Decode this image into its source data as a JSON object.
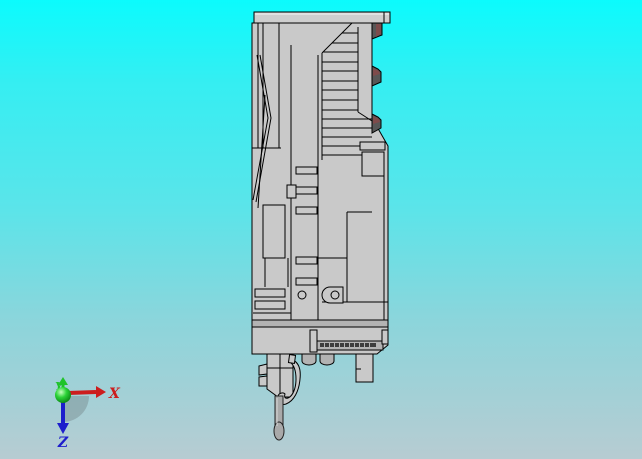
{
  "window": {
    "width": 642,
    "height": 459
  },
  "viewport": {
    "background_gradient": {
      "top": "#0bfbfd",
      "high": "#35eef2",
      "mid": "#5ce4e9",
      "low": "#8cd5db",
      "bottom": "#b7ccd2"
    }
  },
  "model": {
    "body_color": "#c9c9c9",
    "cap_color": "#cfcfcf",
    "face_shade_color": "#b3b3b3",
    "dark_detail_color": "#575757",
    "accent_detail_color": "#7d4b4b",
    "needle_color": "#a9a9a9",
    "outline_color": "#000000"
  },
  "triad": {
    "x_axis": {
      "label": "X",
      "color": "#cc1d1d"
    },
    "y_axis": {
      "label": "Y",
      "color": "#1fc32a"
    },
    "z_axis": {
      "label": "Z",
      "color": "#1d1dcc"
    },
    "origin_color": "#2bd337",
    "shadow_color": "#76878c"
  }
}
